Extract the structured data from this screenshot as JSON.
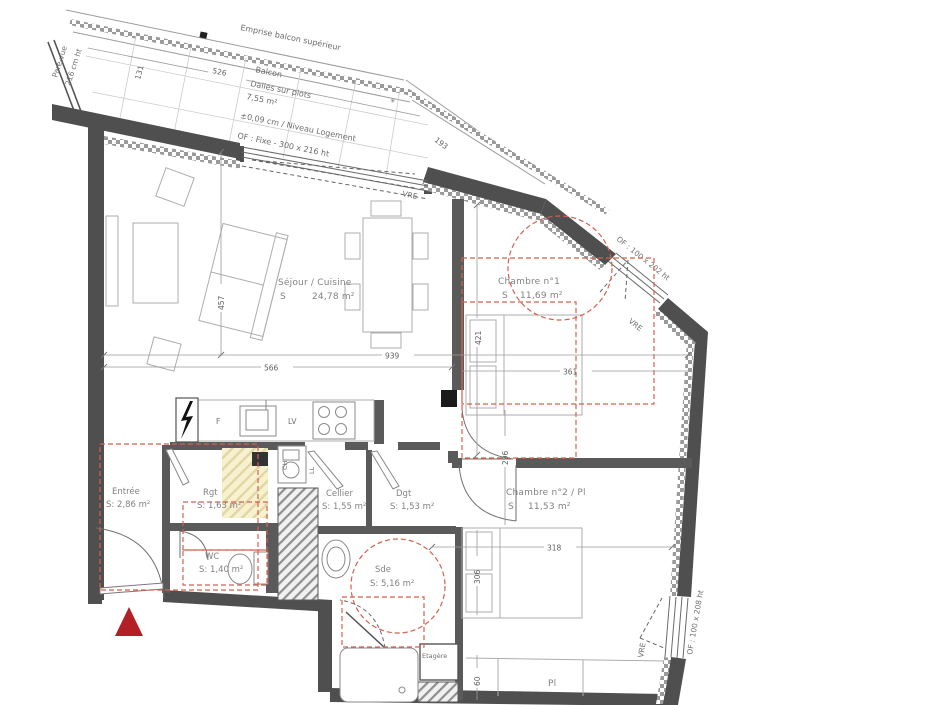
{
  "plan": {
    "balcony": {
      "emprise": "Emprise balcon supérieur",
      "pare_vue_1": "Pare-vue",
      "pare_vue_2": "216 cm ht",
      "name": "Balcon",
      "sub": "Dalles sur plots",
      "area": "7,55 m²",
      "level": "±0,09 cm / Niveau Logement",
      "window": "OF : Fixe - 300 x 216 ht"
    },
    "rooms": {
      "sejour": {
        "name": "Séjour / Cuisine",
        "s_label": "S",
        "area": "24,78 m²"
      },
      "ch1": {
        "name": "Chambre n°1",
        "s_label": "S",
        "area": "11,69 m²"
      },
      "ch2": {
        "name": "Chambre n°2 / Pl",
        "s_label": "S",
        "area": "11,53 m²"
      },
      "entree": {
        "name": "Entrée",
        "area": "S: 2,86 m²"
      },
      "rgt": {
        "name": "Rgt",
        "area": "S: 1,63 m²"
      },
      "wc": {
        "name": "WC",
        "area": "S: 1,40 m²"
      },
      "cellier": {
        "name": "Cellier",
        "area": "S: 1,55 m²"
      },
      "dgt": {
        "name": "Dgt",
        "area": "S: 1,53 m²"
      },
      "sde": {
        "name": "Sde",
        "area": "S: 5,16 m²"
      }
    },
    "features": {
      "etagere": "Etagère",
      "pl": "Pl",
      "fridge": "F",
      "dishwasher": "LV",
      "water_heater": "CH",
      "washer": "LL"
    },
    "windows": {
      "upper_right": "OF : 100 x 202 ht",
      "lower_right": "OF : 100 x 208 ht",
      "vre": "VRE"
    },
    "dims": {
      "d526": "526",
      "d131": "131",
      "d193": "193",
      "d457": "457",
      "d939": "939",
      "d566": "566",
      "d421": "421",
      "d361": "361",
      "d296": "296",
      "d318": "318",
      "d306": "306",
      "d60": "60"
    },
    "colors": {
      "wall": "#4f4f4f",
      "red_dash": "#d4604f",
      "marker_red": "#b22025",
      "yellow_zone": "#f7f1cf"
    }
  }
}
